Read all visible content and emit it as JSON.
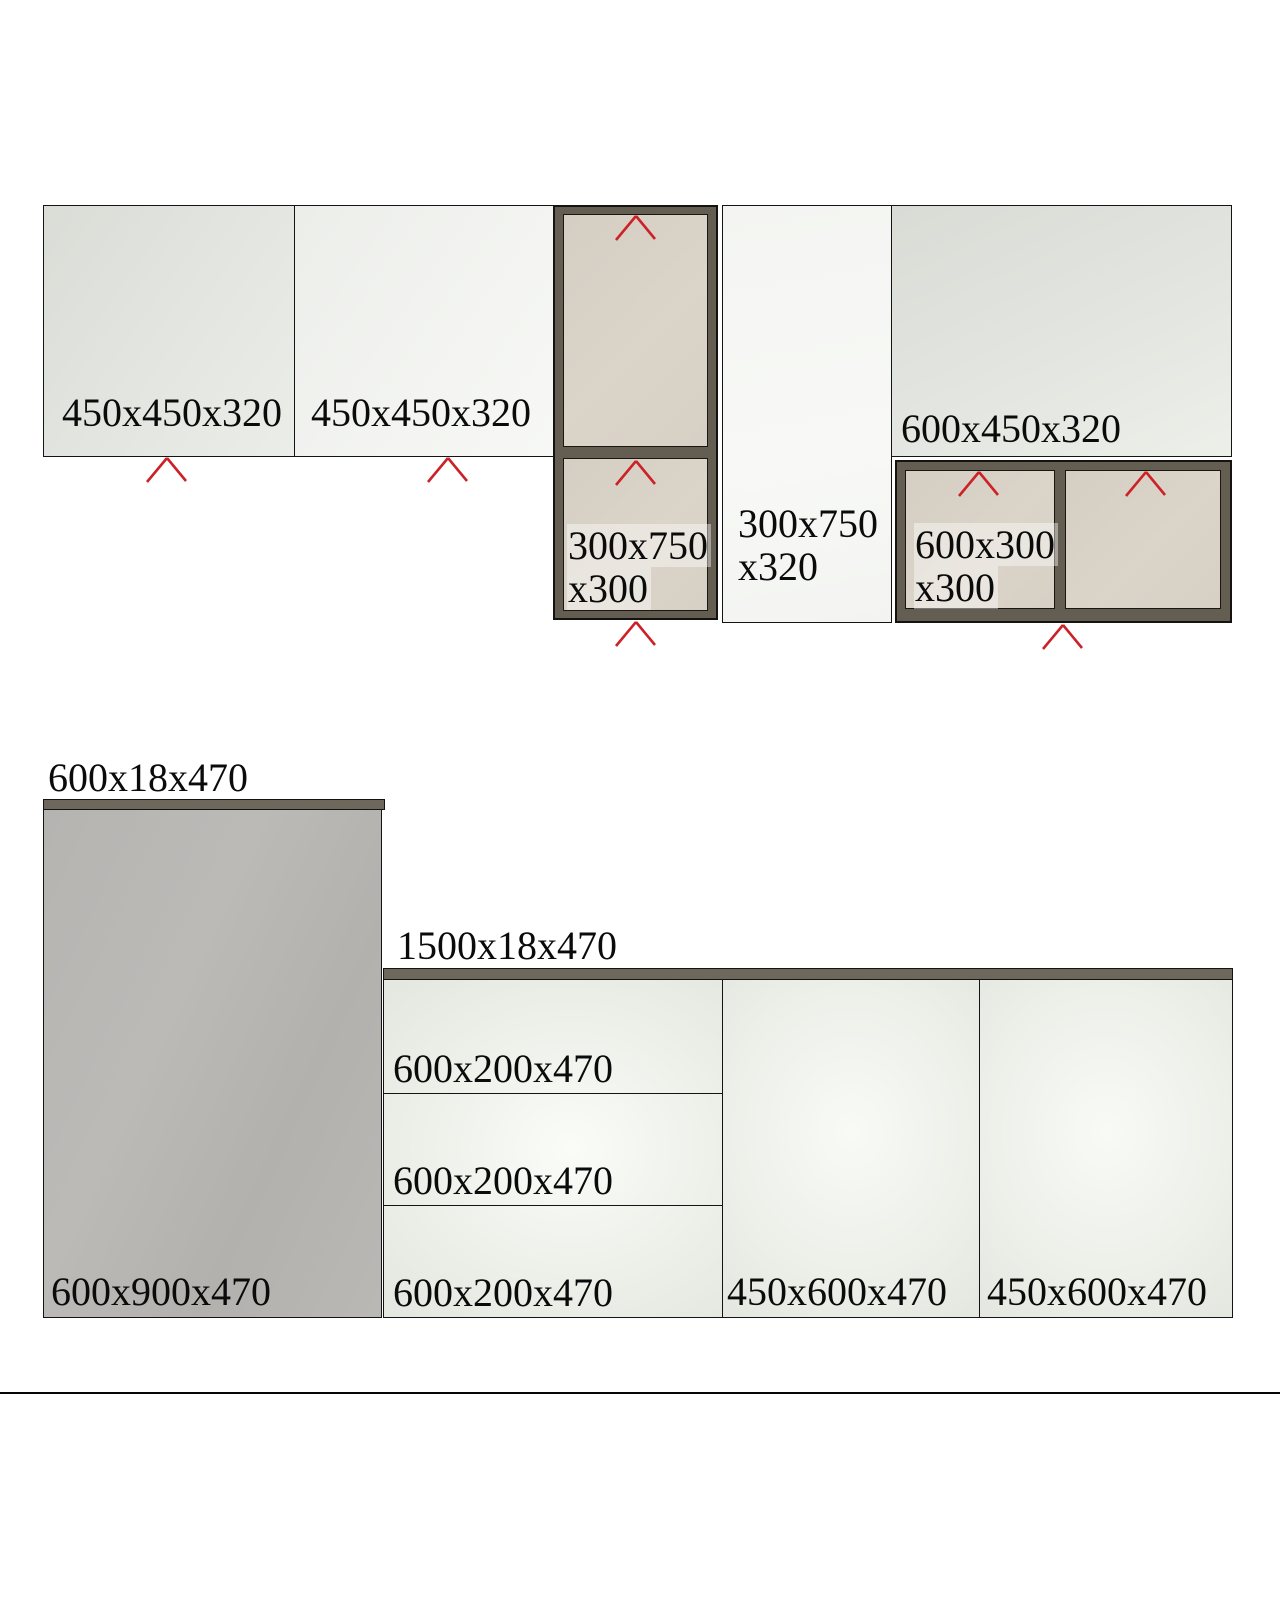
{
  "drawing_title": "kitchen-cabinet-elevations",
  "colors": {
    "background": "#ffffff",
    "chevron_red": "#cc2127",
    "frame_dark": "#635d52",
    "countertop_dark": "#6e675c",
    "shelf_interior_beige": "#d8d1c6",
    "tall_cabinet_gray": "#b8b6b3",
    "outline": "#141414"
  },
  "top_row": {
    "wall_cabinet_1": {
      "label": "450x450x320"
    },
    "wall_cabinet_2": {
      "label": "450x450x320"
    },
    "open_shelf_unit_left": {
      "label_line1": "300x750",
      "label_line2": "x300"
    },
    "tall_door_cabinet": {
      "label_line1": "300x750",
      "label_line2": "x320"
    },
    "wall_cabinet_3": {
      "label": "600x450x320"
    },
    "open_shelf_unit_right": {
      "label_line1": "600x300",
      "label_line2": "x300"
    }
  },
  "bottom_row": {
    "countertop_left": {
      "label": "600x18x470"
    },
    "tall_base_cabinet": {
      "label": "600x900x470"
    },
    "countertop_right": {
      "label": "1500x18x470"
    },
    "drawers": [
      {
        "label": "600x200x470"
      },
      {
        "label": "600x200x470"
      },
      {
        "label": "600x200x470"
      }
    ],
    "door_1": {
      "label": "450x600x470"
    },
    "door_2": {
      "label": "450x600x470"
    }
  }
}
